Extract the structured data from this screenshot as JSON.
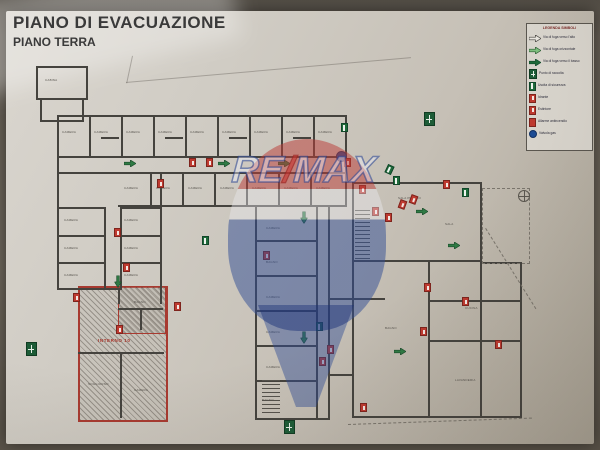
{
  "title": "PIANO DI EVACUAZIONE",
  "subtitle": "PIANO TERRA",
  "legend": {
    "title": "LEGENDA SIMBOLI",
    "items": [
      {
        "icon": "escape-route-up-arrow-icon",
        "style": "arrow-outline",
        "label": "Via di fuga verso l'alto"
      },
      {
        "icon": "escape-route-arrow-icon",
        "style": "arrow-light",
        "label": "Via di fuga orizzontale"
      },
      {
        "icon": "escape-route-down-arrow-icon",
        "style": "arrow-dark",
        "label": "Via di fuga verso il basso"
      },
      {
        "icon": "assembly-point-icon",
        "style": "assembly",
        "label": "Punto di raccolta"
      },
      {
        "icon": "emergency-exit-icon",
        "style": "exit",
        "label": "Uscita di sicurezza"
      },
      {
        "icon": "hydrant-icon",
        "style": "ext",
        "label": "Idrante"
      },
      {
        "icon": "extinguisher-icon",
        "style": "ext",
        "label": "Estintore"
      },
      {
        "icon": "fire-alarm-icon",
        "style": "alarm",
        "label": "Allarme antincendio"
      },
      {
        "icon": "gas-valve-icon",
        "style": "gas",
        "label": "Valvola gas"
      }
    ]
  },
  "watermark": {
    "re": "RE",
    "slash": "/",
    "max": "MAX",
    "blue": "#1d3f8f",
    "red": "#c43430"
  },
  "colors": {
    "paper": "#cfcac2",
    "wall": "#45433e",
    "symbol-red": "#bf3a30",
    "symbol-green": "#1f6b3a",
    "symbol-blue": "#1d4c95",
    "hatch-border": "#a83a30"
  },
  "plan": {
    "unit_label": "INTERNO 10",
    "room_labels": [
      {
        "text": "CABINA",
        "x": 45,
        "y": 78
      },
      {
        "text": "CAMERA",
        "x": 62,
        "y": 130
      },
      {
        "text": "CAMERA",
        "x": 94,
        "y": 130
      },
      {
        "text": "CAMERA",
        "x": 126,
        "y": 130
      },
      {
        "text": "CAMERA",
        "x": 158,
        "y": 130
      },
      {
        "text": "CAMERA",
        "x": 190,
        "y": 130
      },
      {
        "text": "CAMERA",
        "x": 222,
        "y": 130
      },
      {
        "text": "CAMERA",
        "x": 254,
        "y": 130
      },
      {
        "text": "CAMERA",
        "x": 286,
        "y": 130
      },
      {
        "text": "CAMERA",
        "x": 318,
        "y": 130
      },
      {
        "text": "CAMERA",
        "x": 124,
        "y": 186
      },
      {
        "text": "CAMERA",
        "x": 156,
        "y": 186
      },
      {
        "text": "CAMERA",
        "x": 188,
        "y": 186
      },
      {
        "text": "CAMERA",
        "x": 220,
        "y": 186
      },
      {
        "text": "CAMERA",
        "x": 252,
        "y": 186
      },
      {
        "text": "CAMERA",
        "x": 284,
        "y": 186
      },
      {
        "text": "CAMERA",
        "x": 316,
        "y": 186
      },
      {
        "text": "CAMERA",
        "x": 64,
        "y": 218
      },
      {
        "text": "CAMERA",
        "x": 124,
        "y": 218
      },
      {
        "text": "CAMERA",
        "x": 64,
        "y": 246
      },
      {
        "text": "CAMERA",
        "x": 124,
        "y": 246
      },
      {
        "text": "CAMERA",
        "x": 64,
        "y": 273
      },
      {
        "text": "CAMERA",
        "x": 124,
        "y": 273
      },
      {
        "text": "CAMERA",
        "x": 266,
        "y": 226
      },
      {
        "text": "BAGNO",
        "x": 266,
        "y": 260
      },
      {
        "text": "CAMERA",
        "x": 266,
        "y": 295
      },
      {
        "text": "CAMERA",
        "x": 266,
        "y": 330
      },
      {
        "text": "CAMERA",
        "x": 266,
        "y": 365
      },
      {
        "text": "BAGNO",
        "x": 262,
        "y": 398
      },
      {
        "text": "SALA PRANZO",
        "x": 398,
        "y": 196
      },
      {
        "text": "SALA",
        "x": 445,
        "y": 222
      },
      {
        "text": "CUCINA",
        "x": 465,
        "y": 306
      },
      {
        "text": "BAGNO",
        "x": 385,
        "y": 326
      },
      {
        "text": "LAVANDERIA",
        "x": 455,
        "y": 378
      },
      {
        "text": "BAGNO",
        "x": 134,
        "y": 300
      },
      {
        "text": "SOGGIORNO",
        "x": 88,
        "y": 382
      },
      {
        "text": "CAMERA",
        "x": 134,
        "y": 388
      }
    ],
    "symbols": [
      {
        "t": "assembly",
        "x": 26,
        "y": 342
      },
      {
        "t": "assembly",
        "x": 424,
        "y": 112
      },
      {
        "t": "assembly",
        "x": 284,
        "y": 420
      },
      {
        "t": "gas",
        "x": 336,
        "y": 151
      },
      {
        "t": "north",
        "x": 518,
        "y": 190
      },
      {
        "t": "ext",
        "x": 189,
        "y": 158
      },
      {
        "t": "ext",
        "x": 206,
        "y": 158
      },
      {
        "t": "ext",
        "x": 157,
        "y": 179
      },
      {
        "t": "ext",
        "x": 114,
        "y": 228
      },
      {
        "t": "ext",
        "x": 123,
        "y": 263
      },
      {
        "t": "ext",
        "x": 73,
        "y": 293
      },
      {
        "t": "ext",
        "x": 116,
        "y": 325
      },
      {
        "t": "ext",
        "x": 174,
        "y": 302
      },
      {
        "t": "ext",
        "x": 263,
        "y": 251
      },
      {
        "t": "ext",
        "x": 327,
        "y": 345
      },
      {
        "t": "ext",
        "x": 319,
        "y": 357
      },
      {
        "t": "ext",
        "x": 344,
        "y": 158
      },
      {
        "t": "ext",
        "x": 359,
        "y": 185
      },
      {
        "t": "ext",
        "x": 372,
        "y": 207
      },
      {
        "t": "ext",
        "x": 385,
        "y": 213
      },
      {
        "t": "ext",
        "x": 399,
        "y": 200,
        "r": 20
      },
      {
        "t": "ext",
        "x": 410,
        "y": 195,
        "r": 20
      },
      {
        "t": "ext",
        "x": 443,
        "y": 180
      },
      {
        "t": "ext",
        "x": 424,
        "y": 283
      },
      {
        "t": "ext",
        "x": 462,
        "y": 297
      },
      {
        "t": "ext",
        "x": 495,
        "y": 340
      },
      {
        "t": "ext",
        "x": 420,
        "y": 327
      },
      {
        "t": "ext",
        "x": 360,
        "y": 403
      },
      {
        "t": "arrow",
        "x": 124,
        "y": 160
      },
      {
        "t": "arrow",
        "x": 218,
        "y": 160
      },
      {
        "t": "arrow",
        "x": 278,
        "y": 160
      },
      {
        "t": "arrow",
        "x": 112,
        "y": 278,
        "r": 90
      },
      {
        "t": "arrow",
        "x": 298,
        "y": 214,
        "r": 90
      },
      {
        "t": "arrow",
        "x": 298,
        "y": 334,
        "r": 90
      },
      {
        "t": "arrow",
        "x": 416,
        "y": 208
      },
      {
        "t": "arrow",
        "x": 448,
        "y": 242
      },
      {
        "t": "arrow",
        "x": 394,
        "y": 348
      },
      {
        "t": "exit",
        "x": 386,
        "y": 165,
        "r": 25
      },
      {
        "t": "exit",
        "x": 393,
        "y": 176
      },
      {
        "t": "exit",
        "x": 462,
        "y": 188
      },
      {
        "t": "exit",
        "x": 341,
        "y": 123
      },
      {
        "t": "exit",
        "x": 316,
        "y": 322
      },
      {
        "t": "exit",
        "x": 202,
        "y": 236
      }
    ]
  }
}
